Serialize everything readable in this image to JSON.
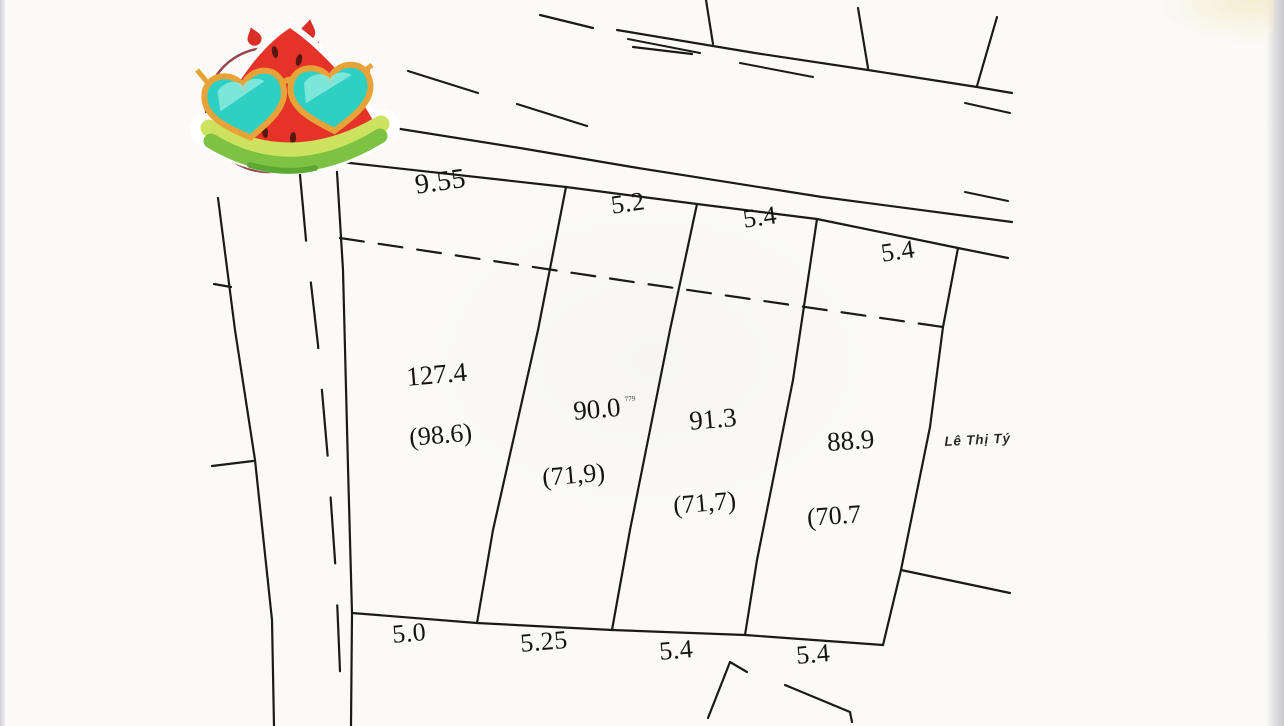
{
  "page": {
    "background_color": "#fbfaf8",
    "line_color": "#1a1a1a",
    "description_hint": "scanned cadastral land-plot sketch"
  },
  "parcels": [
    {
      "area": "127.4",
      "area_secondary": "(98.6)",
      "frontage_top": "9.55",
      "frontage_bottom": "5.0"
    },
    {
      "area": "90.0",
      "area_sup": "779",
      "area_secondary": "(71,9)",
      "frontage_top": "5.2",
      "frontage_bottom": "5.25"
    },
    {
      "area": "91.3",
      "area_secondary": "(71,7)",
      "frontage_top": "5.4",
      "frontage_bottom": "5.4"
    },
    {
      "area": "88.9",
      "area_secondary": "(70.7",
      "frontage_top": "5.4",
      "frontage_bottom": "5.4"
    }
  ],
  "adjacent_owner": "Lê Thị Tý",
  "sticker": {
    "kind": "watermelon-with-heart-sunglasses",
    "colors": {
      "flesh": "#e63329",
      "rind_light": "#cde35f",
      "rind_green": "#7dc243",
      "lens": "#2fd0c4",
      "frame": "#e8a338",
      "stamp_ring": "#8a2f3a"
    }
  }
}
